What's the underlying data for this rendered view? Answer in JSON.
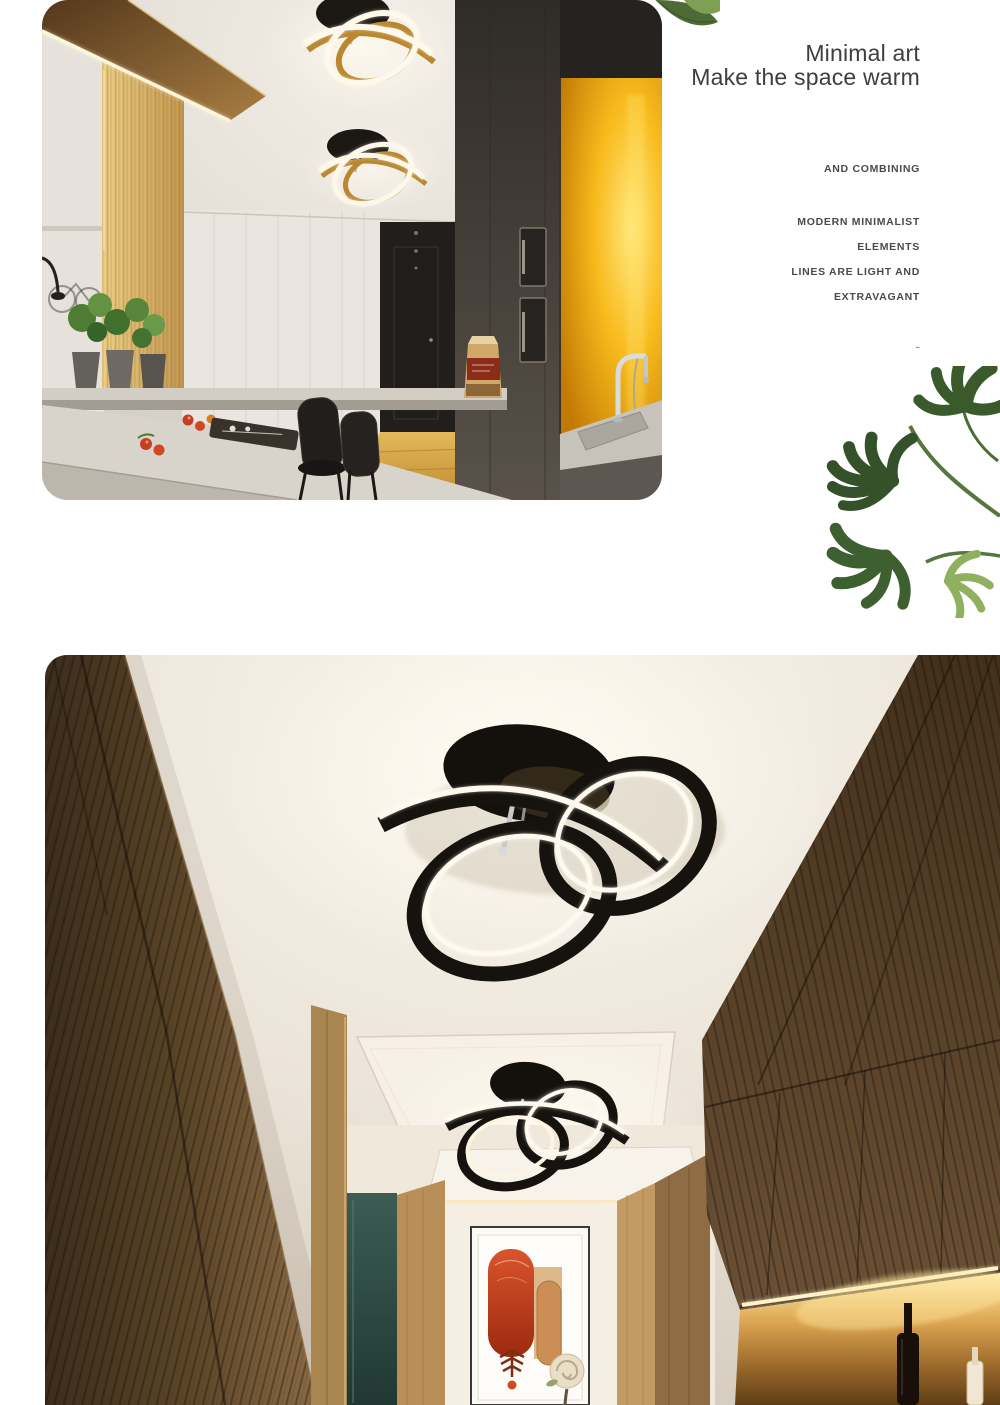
{
  "hero": {
    "title_line1": "Minimal art",
    "title_line2": "Make the space warm",
    "kicker": "AND COMBINING",
    "features": [
      "MODERN MINIMALIST",
      "ELEMENTS",
      "LINES ARE LIGHT AND",
      "EXTRAVAGANT"
    ],
    "dash": "-"
  },
  "photos": {
    "kitchen_alt": "kitchen aisle with two black and gold knot ceiling lamps",
    "hallway_alt": "wood panelled hallway with black knot LED ceiling lamps"
  },
  "decor": {
    "leaf_top_icon": "monstera-leaf-icon",
    "leaves_right_icon": "monstera-leaves-icon"
  },
  "colors": {
    "title_text": "#3e3e3e",
    "feature_text": "#4a4a4a",
    "leaf_green": "#3f5a31",
    "lamp_black": "#16120e",
    "lamp_glow": "#fdf5e2",
    "wood_brown": "#6b5339",
    "backlight_yellow": "#f7b417",
    "artwork_red": "#c23d1c"
  }
}
